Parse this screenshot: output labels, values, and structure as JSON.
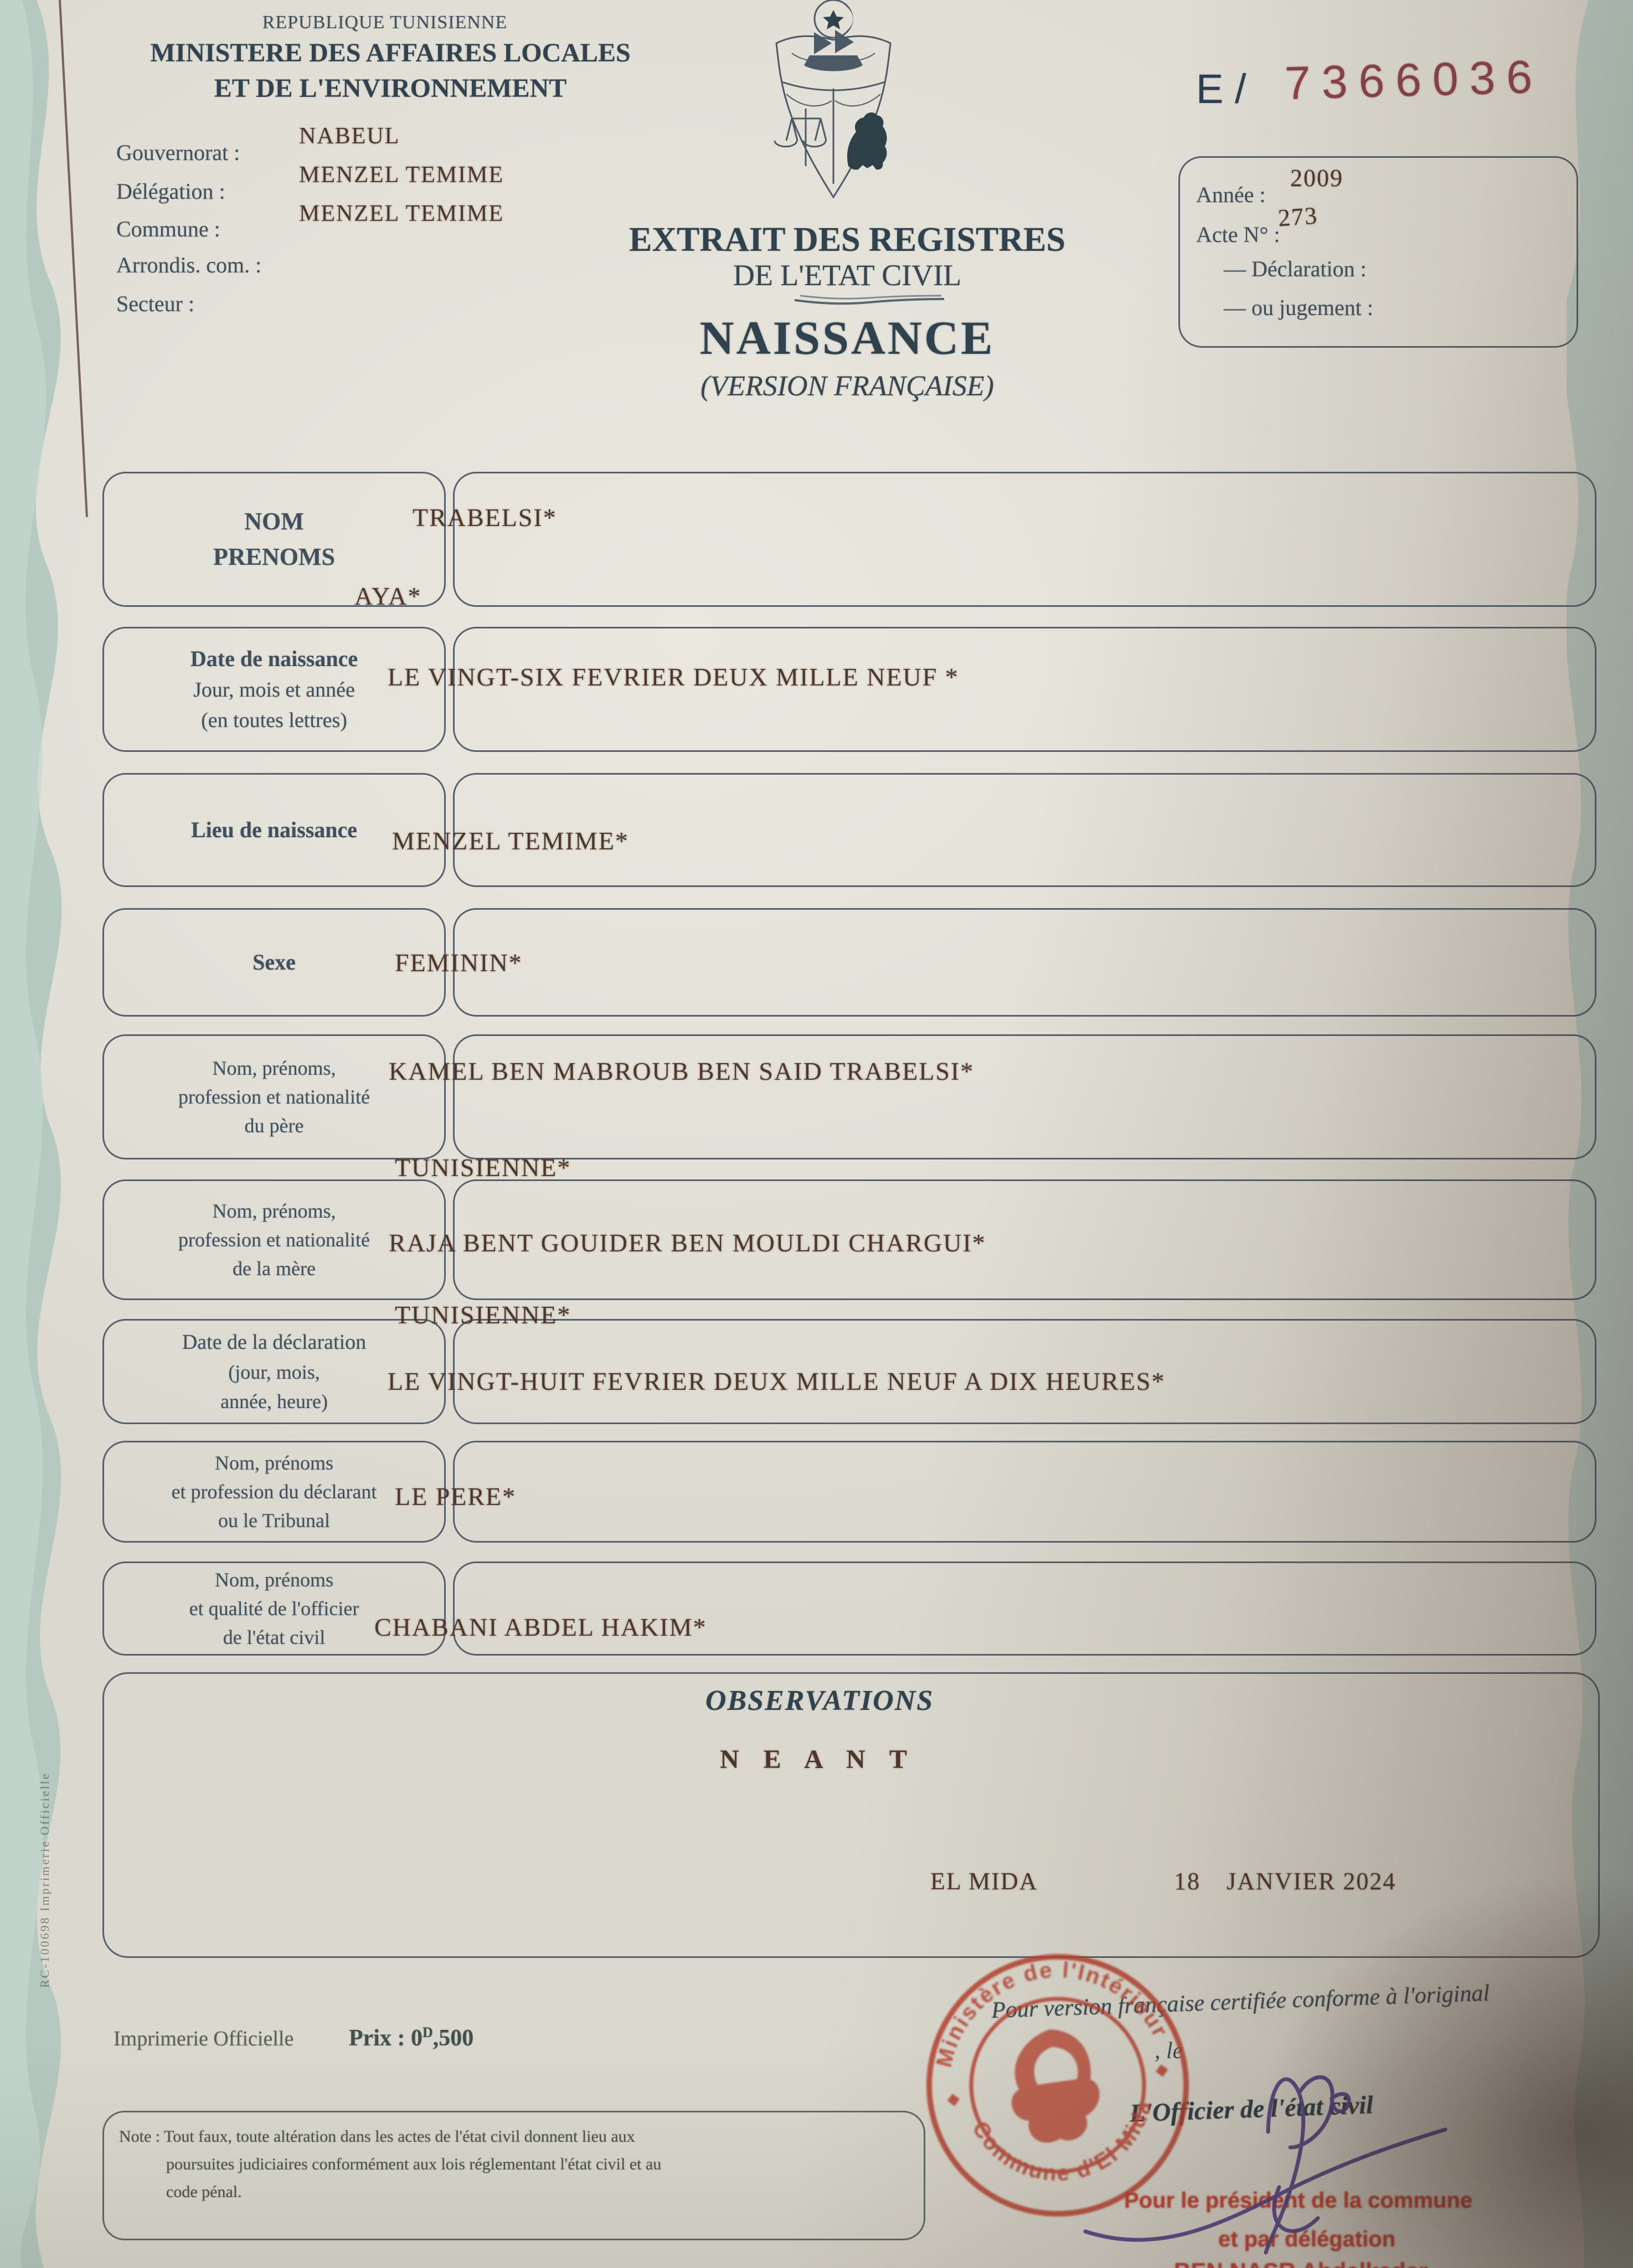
{
  "header": {
    "republic": "REPUBLIQUE TUNISIENNE",
    "ministry_line1": "MINISTERE DES AFFAIRES LOCALES",
    "ministry_line2": "ET DE L'ENVIRONNEMENT",
    "admin_fields": [
      {
        "label": "Gouvernorat :",
        "value": "NABEUL"
      },
      {
        "label": "Délégation :",
        "value": "MENZEL TEMIME"
      },
      {
        "label": "Commune :",
        "value": "MENZEL TEMIME"
      },
      {
        "label": "Arrondis. com. :",
        "value": ""
      },
      {
        "label": "Secteur :",
        "value": ""
      }
    ],
    "serial_prefix": "E /",
    "serial_number": "7366036",
    "acte_box": {
      "annee_label": "Année :",
      "annee_value": "2009",
      "acte_label": "Acte N° :",
      "acte_value": "273",
      "declaration_label": "— Déclaration :",
      "jugement_label": "— ou jugement :"
    },
    "title_line1": "EXTRAIT DES REGISTRES",
    "title_line2": "DE L'ETAT CIVIL",
    "title_main": "NAISSANCE",
    "title_sub": "(VERSION FRANÇAISE)"
  },
  "form": {
    "rows": [
      {
        "label_lines": [
          "NOM",
          "PRENOMS"
        ],
        "value": "TRABELSI*",
        "value2": "AYA*"
      },
      {
        "label_lines": [
          "Date de naissance",
          "Jour, mois et année",
          "(en toutes lettres)"
        ],
        "value": "LE VINGT-SIX FEVRIER  DEUX MILLE NEUF *"
      },
      {
        "label_lines": [
          "Lieu de naissance"
        ],
        "value": "MENZEL TEMIME*"
      },
      {
        "label_lines": [
          "Sexe"
        ],
        "value": "FEMININ*"
      },
      {
        "label_lines": [
          "Nom, prénoms,",
          "profession et nationalité",
          "du père"
        ],
        "value": "KAMEL BEN MABROUB BEN SAID TRABELSI*",
        "value2": "TUNISIENNE*"
      },
      {
        "label_lines": [
          "Nom, prénoms,",
          "profession et nationalité",
          "de la mère"
        ],
        "value": "RAJA BENT GOUIDER BEN MOULDI CHARGUI*",
        "value2": "TUNISIENNE*"
      },
      {
        "label_lines": [
          "Date de la déclaration",
          "(jour, mois,",
          "année, heure)"
        ],
        "value": "LE VINGT-HUIT FEVRIER  DEUX MILLE NEUF  A DIX HEURES*"
      },
      {
        "label_lines": [
          "Nom, prénoms",
          "et profession du déclarant",
          "ou le Tribunal"
        ],
        "value": "LE PERE*"
      },
      {
        "label_lines": [
          "Nom, prénoms",
          "et qualité de l'officier",
          "de l'état civil"
        ],
        "value": "CHABANI ABDEL HAKIM*"
      }
    ]
  },
  "observations": {
    "title": "OBSERVATIONS",
    "value": "N E A N T",
    "place": "EL MIDA",
    "day": "18",
    "month_year": "JANVIER 2024"
  },
  "footer": {
    "printer": "Imprimerie Officielle",
    "price_prefix": "Prix : 0",
    "price_sup": "D",
    "price_suffix": ",500",
    "note_line1": "Note : Tout faux, toute altération dans les actes de l'état civil donnent lieu aux",
    "note_line2": "poursuites judiciaires conformément aux lois réglementant l'état civil et au",
    "note_line3": "code pénal.",
    "side_text": "RC-100698    Imprimerie Officielle",
    "certification": "Pour version française certifiée conforme à l'original",
    "le": ", le",
    "officer_title": "L'Officier de l'état civil",
    "red_line1": "Pour le président de la commune",
    "red_line2": "et par délégation",
    "red_line3": "BEN NASR Abdelkader"
  },
  "stamp": {
    "top_text": "Ministère de l'Intérieur",
    "bottom_text": "Commune d'El Mida"
  },
  "colors": {
    "paper": "#e2e0d7",
    "ink_blue": "#41505d",
    "typed_sepia": "#4f362b",
    "serial_red": "#8a4248",
    "stamp_red": "#b8402e",
    "bottom_red": "#c04030",
    "signature_purple": "#4e3d85",
    "guilloche_teal": "#aec6bd",
    "box_border": "#55616d"
  }
}
